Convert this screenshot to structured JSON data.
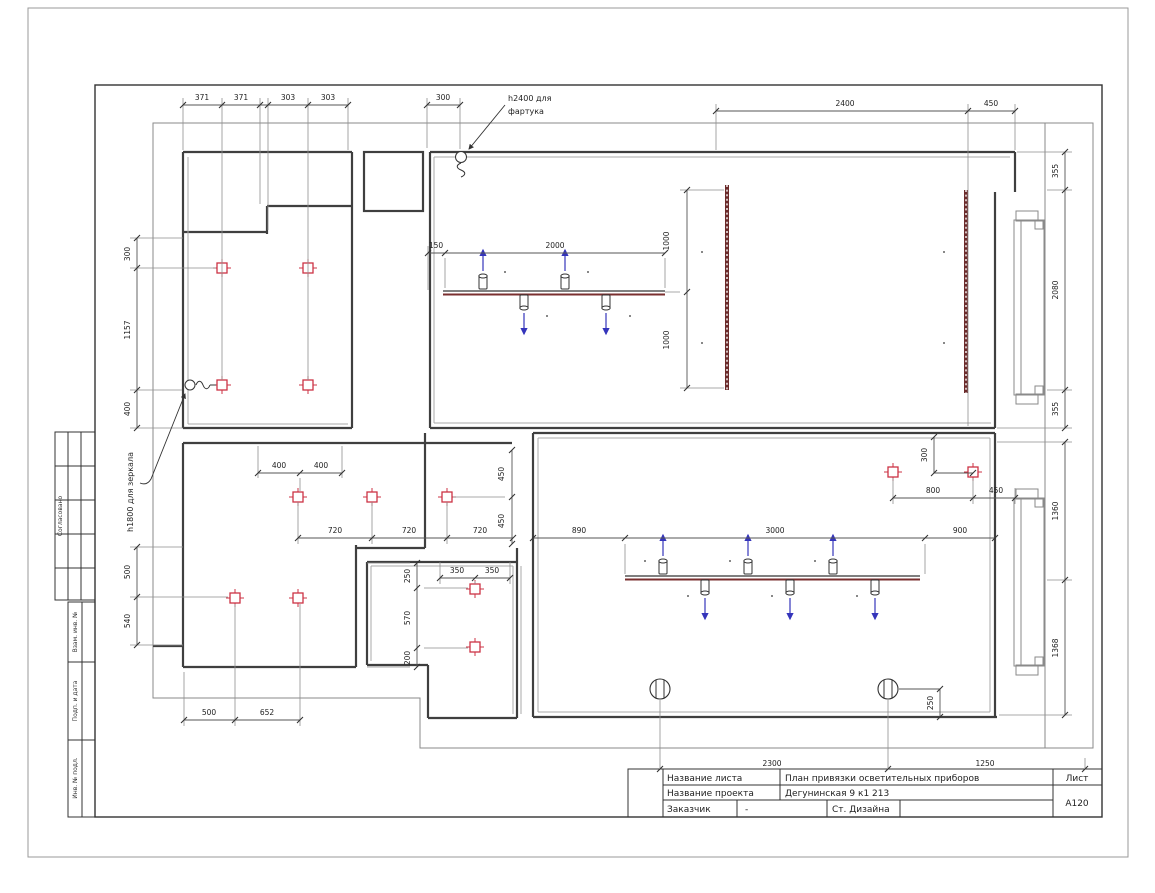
{
  "sheet": {
    "sheet_label": "Лист",
    "sheet_number": "А120"
  },
  "title_block": {
    "row1_label": "Название листа",
    "row1_value": "План привязки осветительных приборов",
    "row2_label": "Название проекта",
    "row2_value": "Дегунинская 9 к1 213",
    "row3_label": "Заказчик",
    "row3_value": "-",
    "row3_value2": "Ст. Дизайна"
  },
  "stamp_column": {
    "block1": "Согласовано",
    "block2": "Взам. инв. №",
    "block3": "Подп. и дата",
    "block4": "Инв. № подл."
  },
  "annotations": {
    "apron_l1": "h2400 для",
    "apron_l2": "фартука",
    "mirror": "h1800 для зеркала"
  },
  "colors": {
    "fixture_red": "#cc3344",
    "arrow_blue": "#3434bb",
    "track_maroon": "#7a2f2f"
  },
  "dims": {
    "t371a": "371",
    "t371b": "371",
    "t303a": "303",
    "t303b": "303",
    "t300": "300",
    "t2400": "2400",
    "t450": "450",
    "k150": "150",
    "k2000": "2000",
    "k1000a": "1000",
    "k1000b": "1000",
    "l300": "300",
    "l1157": "1157",
    "l400": "400",
    "l500": "500",
    "l540": "540",
    "r355a": "355",
    "r2080": "2080",
    "r355b": "355",
    "r1360": "1360",
    "r1368": "1368",
    "m400a": "400",
    "m400b": "400",
    "m720a": "720",
    "m720b": "720",
    "m720c": "720",
    "m450a": "450",
    "m450b": "450",
    "s350a": "350",
    "s350b": "350",
    "s250": "250",
    "s570": "570",
    "s200": "200",
    "b500": "500",
    "b652": "652",
    "w890": "890",
    "w3000": "3000",
    "w900": "900",
    "w300": "300",
    "w800": "800",
    "w450": "450",
    "w250": "250",
    "bt2300": "2300",
    "bt1250": "1250"
  }
}
